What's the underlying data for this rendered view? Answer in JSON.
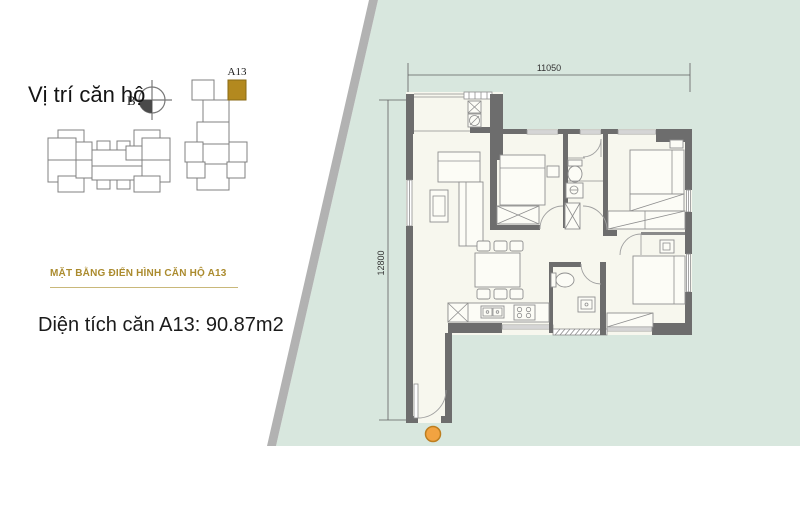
{
  "panel": {
    "location_label": "Vị trí căn hộ",
    "compass_label": "B",
    "unit_label": "A13",
    "section_heading": "MẶT BẰNG ĐIỂN HÌNH CĂN HỘ A13",
    "area_text": "Diện tích căn A13: 90.87m2"
  },
  "floor_plan": {
    "width_dimension": "11050",
    "height_dimension": "12800"
  },
  "colors": {
    "site_background": "#d8e7de",
    "site_edge_band": "#b2b2b2",
    "plan_interior": "#f7f7ee",
    "wall": "#6d6d6d",
    "accent_gold": "#ab8b2e",
    "highlight_unit": "#b3891f",
    "entrance_marker": "#f2a341"
  }
}
